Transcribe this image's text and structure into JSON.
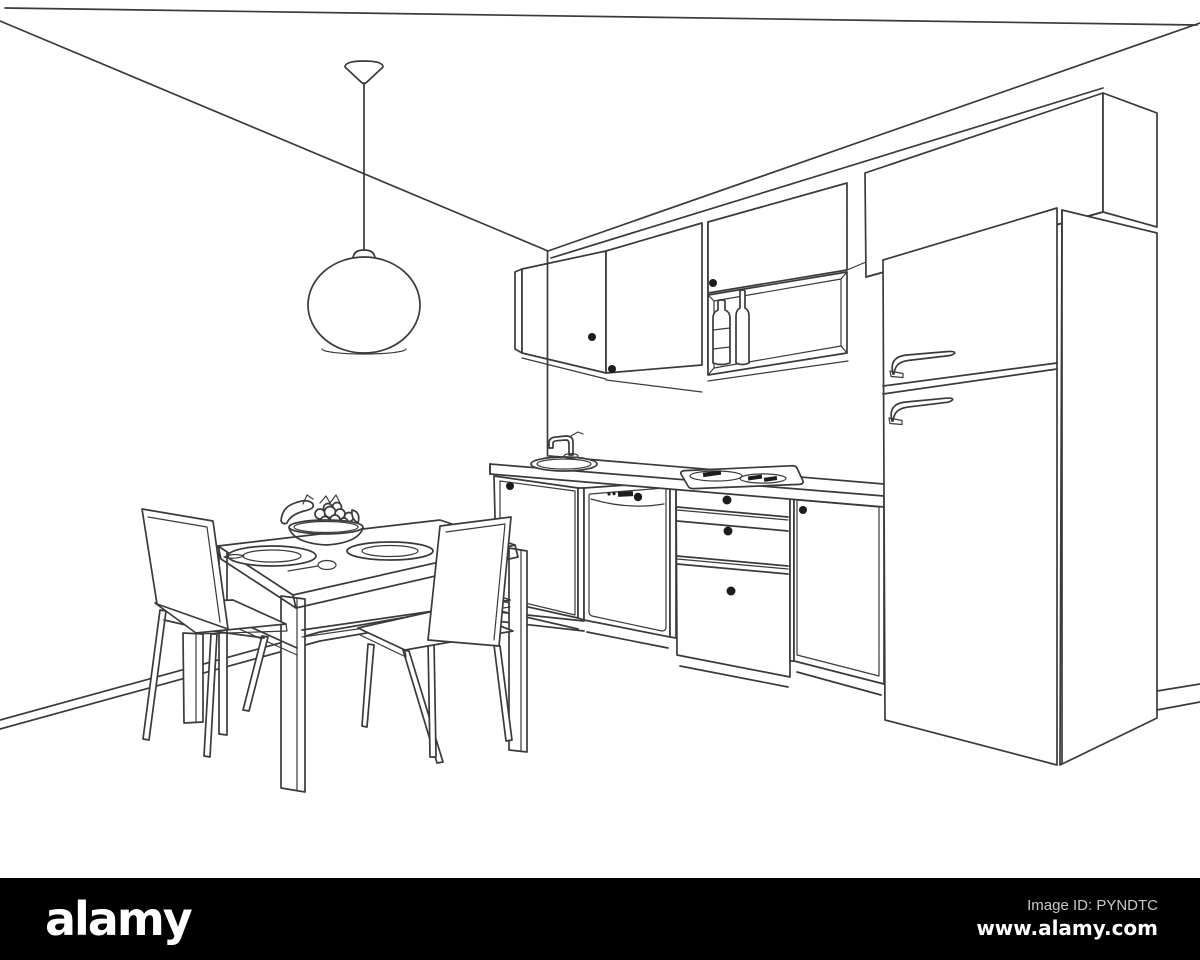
{
  "canvas": {
    "background": "#ffffff",
    "line_color": "#3a3a3a",
    "knob_color": "#1c1c1c"
  },
  "scene": {
    "description": "perspective-line-sketch-of-kitchen-interior",
    "objects": [
      "pendant-lamp",
      "dining-table",
      "chair-left",
      "chair-right",
      "fruit-bowl",
      "plate",
      "plate",
      "spoon",
      "knife",
      "wall-cabinets",
      "shelf-bottles",
      "sink",
      "faucet",
      "cooktop",
      "dishwasher",
      "drawer-unit",
      "base-cabinet",
      "refrigerator",
      "upper-cabinet",
      "baseboard"
    ]
  },
  "footer": {
    "brand": "alamy",
    "image_id": "Image ID: PYNDTC",
    "website": "www.alamy.com",
    "background": "#000000",
    "brand_color": "#ffffff",
    "id_color": "#c9c9c9"
  }
}
